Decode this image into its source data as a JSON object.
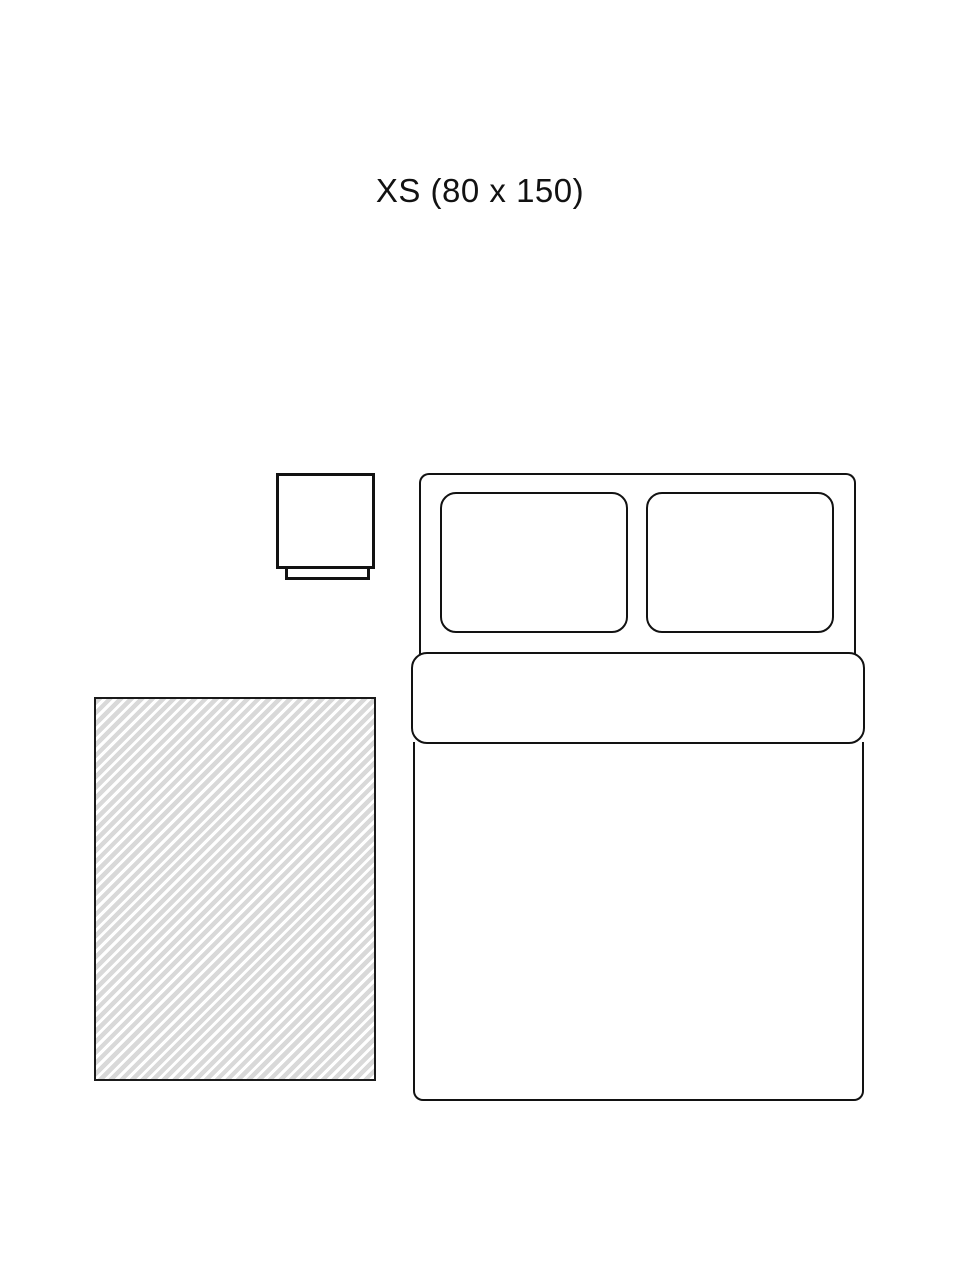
{
  "title": {
    "text": "XS (80 x 150)"
  },
  "size": {
    "code": "XS",
    "width_cm": "80",
    "length_cm": "150"
  },
  "colors": {
    "background": "#ffffff",
    "outline": "#121212",
    "rug_outline": "#1a1a1a",
    "rug_stripe_gray": "#d9d9d9",
    "rug_stripe_white": "#ffffff"
  },
  "diagram": {
    "elements": [
      "nightstand",
      "double-bed-with-two-pillows",
      "striped-rug"
    ]
  }
}
